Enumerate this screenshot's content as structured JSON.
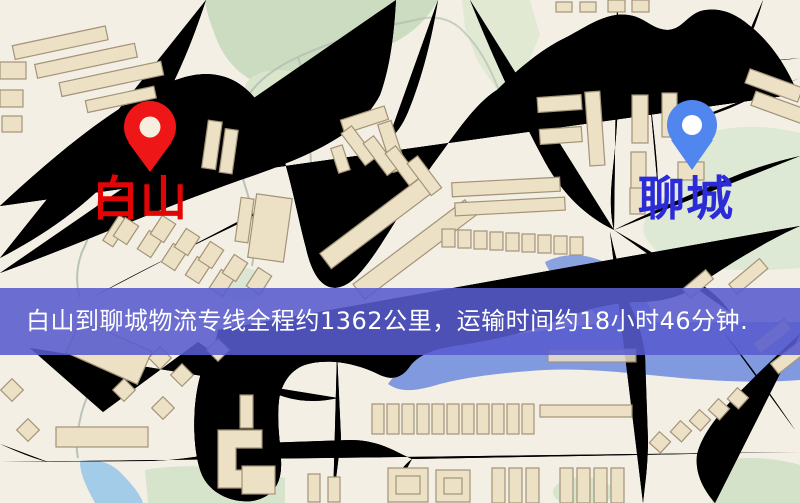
{
  "banner": {
    "text": "白山到聊城物流专线全程约1362公里，运输时间约18小时46分钟.",
    "distance_km": "1362",
    "duration": "18小时46分钟",
    "bg_color": "#585bce",
    "text_color": "#ffffff"
  },
  "markers": {
    "origin": {
      "name": "白山",
      "label_color": "#e30505",
      "pin_color": "#ee1616"
    },
    "destination": {
      "name": "聊城",
      "label_color": "#2b2bd8",
      "pin_color": "#5086ee"
    }
  },
  "map_colors": {
    "background": "#f3efe4",
    "road_fill": "#f6d57b",
    "road_casing": "#e2b857",
    "building_fill": "#ece1c4",
    "building_stroke": "#a39378",
    "park_green": "#cbdcc0",
    "pale_green": "#dde9d4",
    "lake_blue": "#67a7db",
    "river_blue": "#8099df",
    "pond_blue": "#a3cce8",
    "railway_dark": "#2b2b2b"
  }
}
